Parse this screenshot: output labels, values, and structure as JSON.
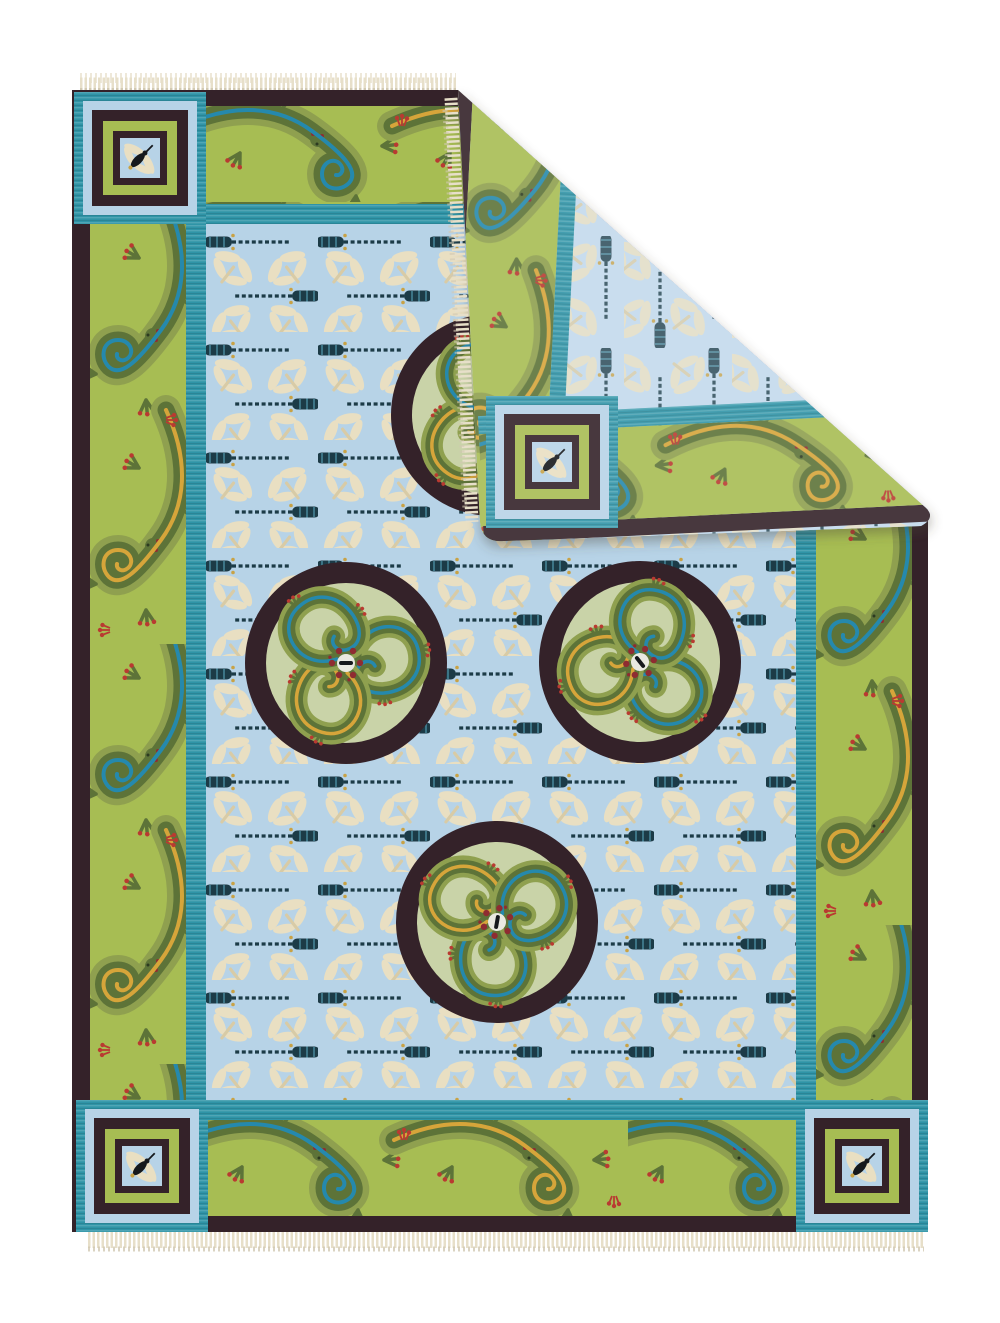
{
  "figure": {
    "alt": "Photograph of a handwoven flatweave kilim area rug on a white background. Light blue field patterned with rows of dragonflies, four circular medallions each holding a pinwheel of three lizards, wide apple-green borders of spiraling lizards with alternating teal and gold stripes, corner squares with single dragonflies, cream fringe at top and bottom, and the top-right corner folded over to reveal the muted reverse side of the weave."
  },
  "palette": {
    "background": "#ffffff",
    "fringe": "#e7dfc9",
    "fringe_shadow": "#d2c9b2",
    "brown": "#342229",
    "border_green": "#a7bd53",
    "teal": "#2f94a7",
    "field_blue": "#b7d3e7",
    "flap_blue": "#c3daec",
    "medallion_green": "#c9d3a8",
    "lizard_dark": "#5d7338",
    "lizard_light": "#8fa04f",
    "stripe_blue": "#2589ad",
    "stripe_gold": "#d6a53a",
    "red": "#b93a31",
    "red_dark": "#8f2c31",
    "fly_navy": "#1c3b47",
    "fly_teal": "#3c7486",
    "fly_gold": "#c8a246",
    "cream": "#e9dfc2",
    "cream_body": "#d8cba6",
    "ink": "#15181c",
    "white_patch": "#e9e9e1",
    "shadow": "#4a4238"
  },
  "rug": {
    "type": "flatweave kilim area rug",
    "orientation": "vertical rectangle, top-right corner folded over showing reverse side",
    "field": {
      "background_color_name": "light blue",
      "motifs": [
        "dark navy segmented dragonflies in horizontal rows",
        "cream dragonflies on diagonals"
      ]
    },
    "medallions": {
      "count_visible": 4,
      "full": 3,
      "partially_hidden_by_fold": 1,
      "design": "dark brown ring around pale green disc with three spiraling lizards, red toes, red-dot cluster at center"
    },
    "borders": {
      "motif": "spiraling lizards with alternating teal and gold back-stripes, red toes and eyes",
      "bands": [
        "dark brown outer band",
        "apple green lizard band",
        "teal inner guard stripe"
      ]
    },
    "corner_squares": {
      "count_visible": 4,
      "design": "concentric teal, light blue, dark brown and green frames around a light blue center with one diagonal dragonfly"
    },
    "fold": {
      "corner": "top-right",
      "reveals": "reverse side of weave in slightly muted colors",
      "flap_contents": [
        "green lizard borders along both edges",
        "corner square",
        "light blue dragonfly field wedge"
      ]
    },
    "fringe": {
      "edges": [
        "top",
        "bottom",
        "folded edge"
      ],
      "color_name": "cream"
    }
  }
}
